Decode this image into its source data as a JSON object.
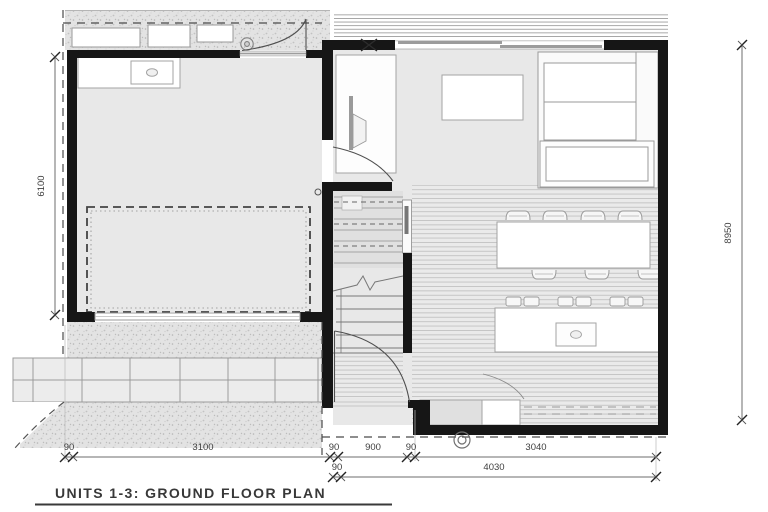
{
  "title": {
    "text": "UNITS 1-3: GROUND FLOOR PLAN"
  },
  "dimensions": {
    "left_vertical": "6100",
    "right_vertical": "8950",
    "bottom_row1": [
      "90",
      "3100",
      "90",
      "900",
      "90",
      "3040"
    ],
    "bottom_row2": [
      "90",
      "4030"
    ]
  },
  "colors": {
    "wall": "#161616",
    "floor_fill": "#e8e8e8",
    "line": "#8f8f8f",
    "dimension_text": "#3f3f3f"
  },
  "symbols": {
    "porch_column": "circle",
    "downpipe": "double-circle",
    "car_space": "dashed-rectangle",
    "window_post": "x-marker"
  }
}
